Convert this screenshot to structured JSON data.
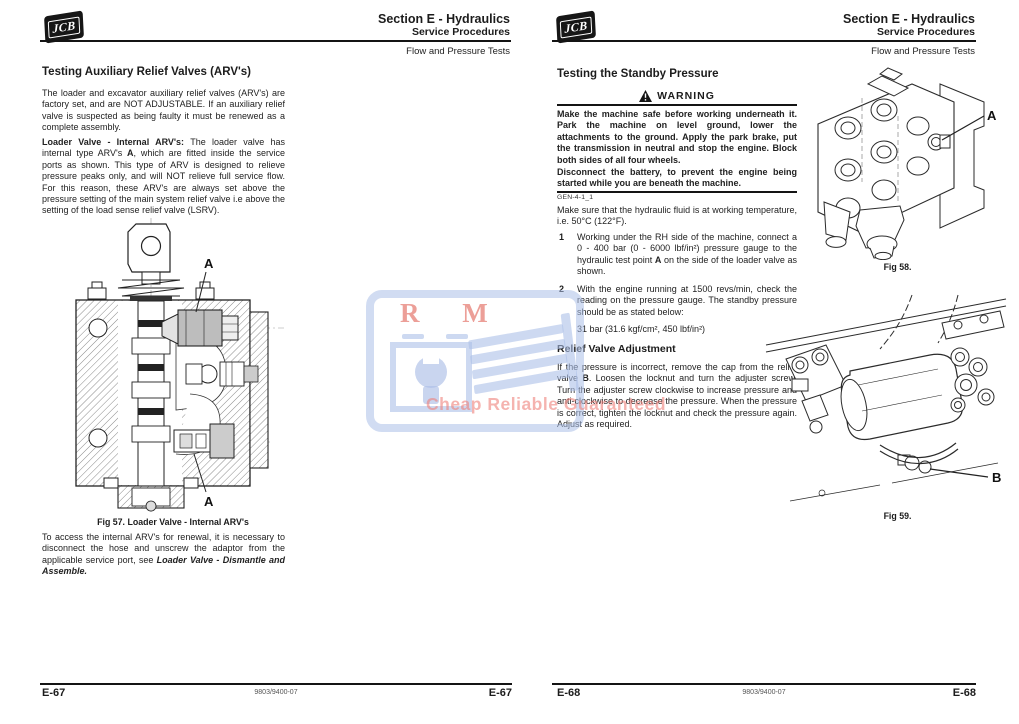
{
  "shared": {
    "logo_text": "JCB",
    "section": "Section E - Hydraulics",
    "subsection": "Service Procedures",
    "topic": "Flow and Pressure Tests",
    "doc_code": "9803/9400-07"
  },
  "left_page": {
    "title": "Testing Auxiliary Relief Valves (ARV's)",
    "para_intro": "The loader and excavator auxiliary relief valves (ARV's) are factory set, and are NOT ADJUSTABLE. If an auxiliary relief valve is suspected as being faulty it must be renewed as a complete assembly.",
    "para_loader_lead": "Loader Valve - Internal ARV's: ",
    "para_loader_pre": "The loader valve has internal type ARV's ",
    "para_loader_ref": "A",
    "para_loader_post": ", which are fitted inside the service ports as shown. This type of ARV is designed to relieve pressure peaks only, and will NOT relieve full service flow. For this reason, these ARV's are always set above the pressure setting of the main system relief valve i.e above the setting of the load sense relief valve (LSRV).",
    "fig57": {
      "caption": "Fig 57. Loader Valve - Internal ARV's",
      "label_a": "A"
    },
    "para_access_pre": "To access the internal ARV's for renewal, it is necessary to disconnect the hose and unscrew the adaptor from the applicable service port, see ",
    "para_access_ref": "Loader Valve - Dismantle and Assemble",
    "para_access_post": ".",
    "page_no": "E-67"
  },
  "right_page": {
    "title": "Testing the Standby Pressure",
    "warning": {
      "title": "WARNING",
      "p1": "Make the machine safe before working underneath it. Park the machine on level ground, lower the attachments to the ground. Apply the park brake, put the transmission in neutral and stop the engine. Block both sides of all four wheels.",
      "p2": "Disconnect the battery, to prevent the engine being started while you are beneath the machine.",
      "code": "GEN-4-1_1"
    },
    "para_temp": "Make sure that the hydraulic fluid is at working temperature, i.e. 50°C (122°F).",
    "steps": [
      {
        "num": "1",
        "pre": "Working under the RH side of the machine, connect a 0 - 400 bar (0 - 6000 lbf/in²) pressure gauge to the hydraulic test point ",
        "ref": "A",
        "post": " on the side of the loader valve as shown."
      },
      {
        "num": "2",
        "pre": "With the engine running at 1500 revs/min, check the reading on the pressure gauge. The standby pressure should be as stated below:",
        "ref": "",
        "post": ""
      }
    ],
    "pressure_value": "31 bar (31.6 kgf/cm², 450 lbf/in²)",
    "relief_title": "Relief Valve Adjustment",
    "relief_pre": "If the pressure is incorrect, remove the cap from the relief valve ",
    "relief_ref": "B",
    "relief_post": ". Loosen the locknut and turn the adjuster screw. Turn the adjuster screw clockwise to increase pressure and anti-clockwise to decrease the pressure. When the pressure is correct, tighten the locknut and check the pressure again. Adjust as required.",
    "fig58": {
      "caption": "Fig 58.",
      "label_a": "A"
    },
    "fig59": {
      "caption": "Fig 59.",
      "label_b": "B"
    },
    "page_no": "E-68"
  },
  "watermark": {
    "letters": "R M",
    "caption": "Cheap Reliable Guaranteed",
    "accent_blue": "#b9c7e9",
    "accent_red": "#e86c61",
    "accent_pink": "#ef8079"
  }
}
